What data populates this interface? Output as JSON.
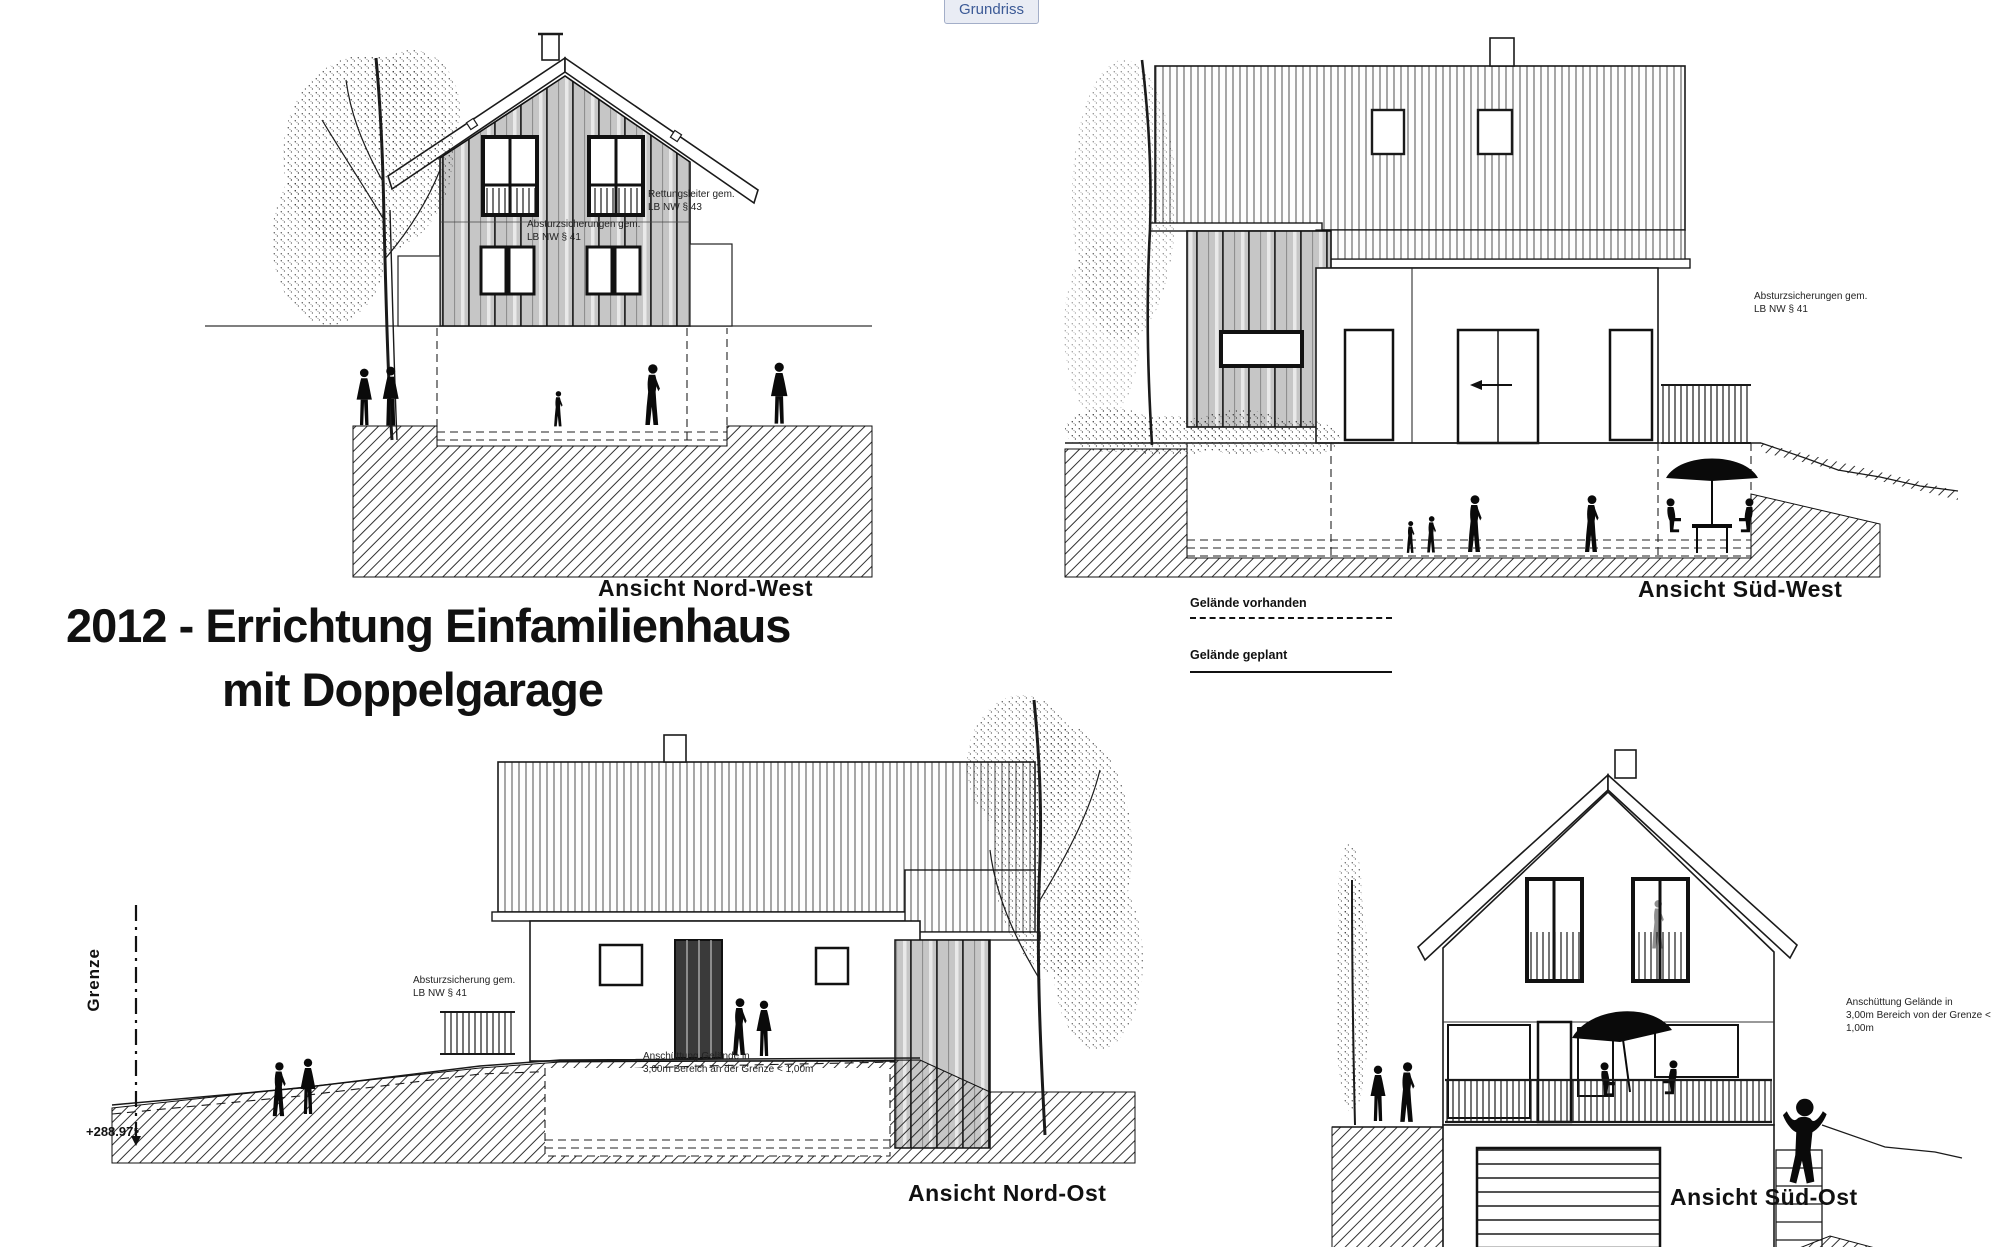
{
  "toolbar": {
    "grundriss_label": "Grundriss"
  },
  "title": {
    "line1": "2012 - Errichtung Einfamilienhaus",
    "line2": "mit Doppelgarage"
  },
  "views": {
    "nord_west": {
      "label": "Ansicht Nord-West"
    },
    "sued_west": {
      "label": "Ansicht Süd-West"
    },
    "nord_ost": {
      "label": "Ansicht Nord-Ost"
    },
    "sued_ost": {
      "label": "Ansicht Süd-Ost"
    }
  },
  "legend": {
    "vorhanden": "Gelände vorhanden",
    "geplant": "Gelände geplant"
  },
  "annotations": {
    "nw_rettung": "Rettungsleiter gem.\nLB NW § 43",
    "nw_absturz": "Absturzsicherungen gem.\nLB NW § 41",
    "sw_absturz": "Absturzsicherungen gem.\nLB NW § 41",
    "no_absturz": "Absturzsicherung gem.\nLB NW § 41",
    "no_anschuettung": "Anschüttung Gelände in\n3,00m Bereich an der Grenze < 1,00m",
    "so_anschuettung": "Anschüttung Gelände in\n3,00m Bereich von der Grenze < 1,00m"
  },
  "markers": {
    "grenze": "Grenze",
    "elevation": "+288.97⁵"
  },
  "colors": {
    "line": "#1a1a1a",
    "siding_gray": "#c6c6c6",
    "button_text": "#3c5a96",
    "button_bg": "#e9ecf4"
  }
}
